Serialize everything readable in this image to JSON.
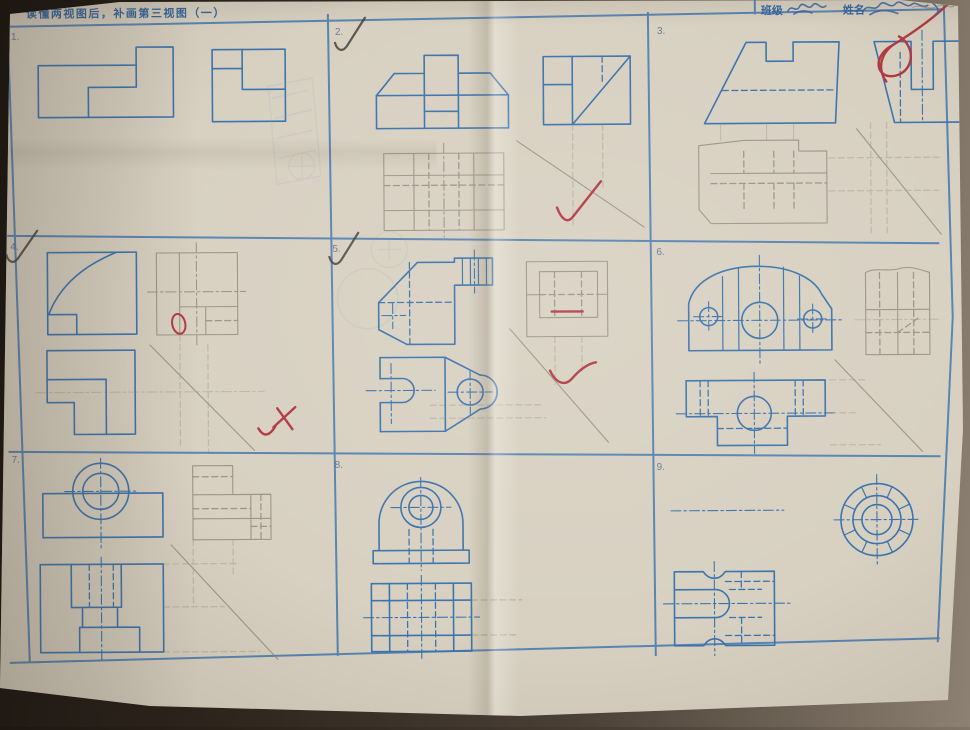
{
  "header": {
    "title": "读懂两视图后，补画第三视图（一）",
    "class_label": "班级",
    "name_label": "姓名"
  },
  "cells": [
    {
      "number": "1."
    },
    {
      "number": "2."
    },
    {
      "number": "3."
    },
    {
      "number": "4."
    },
    {
      "number": "5."
    },
    {
      "number": "6."
    },
    {
      "number": "7."
    },
    {
      "number": "8."
    },
    {
      "number": "9."
    }
  ],
  "marks": [
    {
      "cell": "2",
      "type": "pencil-checkmark-over-number"
    },
    {
      "cell": "4",
      "type": "pencil-checkmark-over-number"
    },
    {
      "cell": "5",
      "type": "pencil-checkmark-over-number"
    },
    {
      "cell": "2",
      "type": "red-check"
    },
    {
      "cell": "4",
      "type": "red-cross-and-oval"
    },
    {
      "cell": "5",
      "type": "red-wavy-check-and-underline"
    },
    {
      "corner": "top-right",
      "type": "red-scribble"
    }
  ],
  "colors": {
    "paper": "#d8d1c2",
    "ink_blue": "#3c74ad",
    "pencil": "#8b8172",
    "red_pen": "#b13a42",
    "table": "#2e251d"
  }
}
